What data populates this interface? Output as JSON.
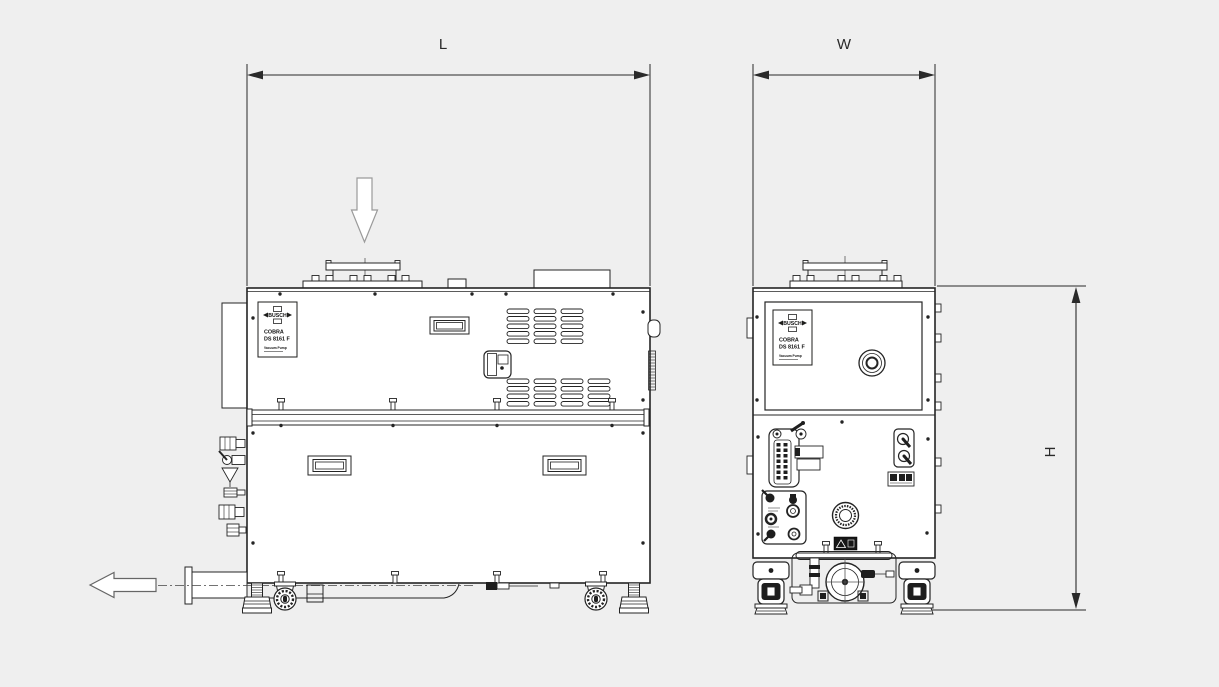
{
  "colors": {
    "background": "#efefef",
    "line": "#242424",
    "fill": "#ffffff"
  },
  "dimension_labels": {
    "length": "L",
    "width": "W",
    "height": "H"
  },
  "nameplate": {
    "brand": "BUSCH",
    "series": "COBRA",
    "model": "DS 8161 F",
    "type": "Vacuum Pump"
  },
  "icons": {
    "inlet_flow": "down-arrow",
    "exhaust_flow": "left-arrow"
  }
}
